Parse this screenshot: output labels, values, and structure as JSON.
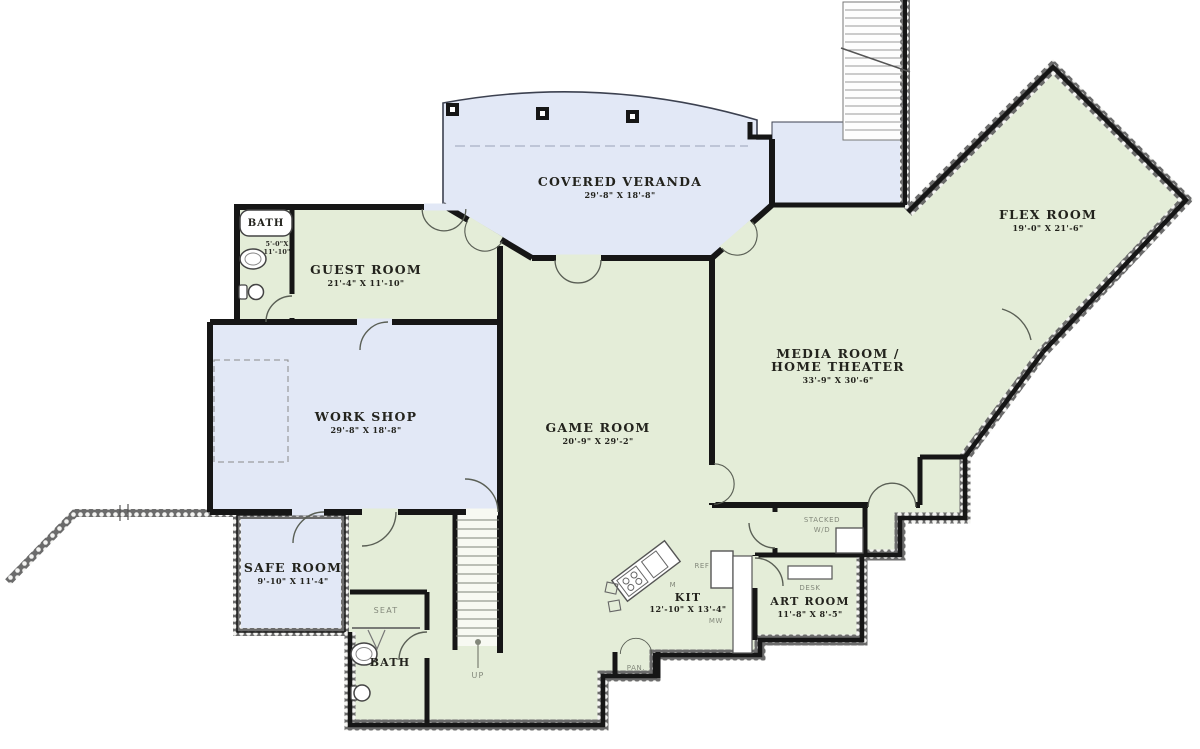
{
  "colors": {
    "room_green": "#e4edd8",
    "porch_blue": "#e2e8f6",
    "wall_black": "#161616",
    "hatch_gray": "#6b6b6b"
  },
  "rooms": {
    "veranda": {
      "name": "COVERED VERANDA",
      "dims": "29'-8\" X 18'-8\""
    },
    "flex": {
      "name": "FLEX ROOM",
      "dims": "19'-0\" X 21'-6\""
    },
    "guest": {
      "name": "GUEST ROOM",
      "dims": "21'-4\" X 11'-10\""
    },
    "bath_main": {
      "name": "BATH",
      "dims_line1": "5'-0\"X",
      "dims_line2": "11'-10\""
    },
    "workshop": {
      "name": "WORK SHOP",
      "dims": "29'-8\" X 18'-8\""
    },
    "game": {
      "name": "GAME ROOM",
      "dims": "20'-9\" X 29'-2\""
    },
    "media": {
      "name_line1": "MEDIA ROOM /",
      "name_line2": "HOME THEATER",
      "dims": "33'-9\" X 30'-6\""
    },
    "safe": {
      "name": "SAFE ROOM",
      "dims": "9'-10\" X 11'-4\""
    },
    "kitchen": {
      "name": "KIT",
      "dims": "12'-10\" X 13'-4\""
    },
    "art": {
      "name": "ART ROOM",
      "dims": "11'-8\" X 8'-5\""
    },
    "bath_lower": {
      "name": "BATH"
    }
  },
  "labels": {
    "seat": "SEAT",
    "up": "UP",
    "stacked_line1": "STACKED",
    "stacked_line2": "W/D",
    "desk": "DESK",
    "ref": "REF",
    "microwave": "M",
    "mw": "MW",
    "pantry": "PAN."
  }
}
